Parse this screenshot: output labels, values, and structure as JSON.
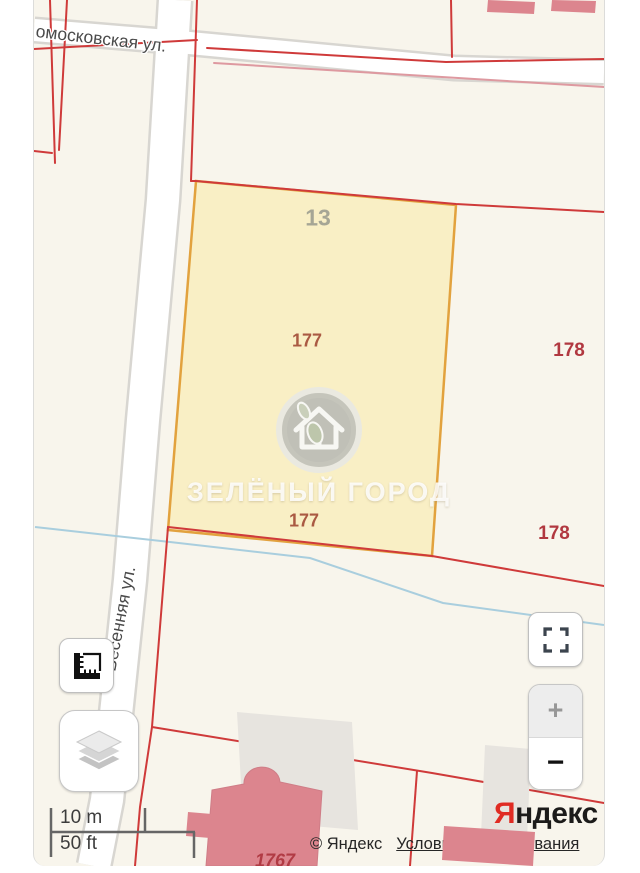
{
  "streets": {
    "top": "омосковская ул.",
    "side": "Весенняя ул."
  },
  "parcels": {
    "block_number": "13",
    "plot_number": "177",
    "adjacent_plot_number": "178",
    "building_number": "1767"
  },
  "watermark": {
    "name": "ЗЕЛЁНЫЙ ГОРОД"
  },
  "scale_bar": {
    "metric": "10 m",
    "imperial": "50 ft"
  },
  "zoom_controls": {
    "zoom_in": "+",
    "zoom_out": "−"
  },
  "attribution": {
    "copyright": "© Яндекс",
    "terms_link": "Условия использования"
  },
  "logo": {
    "letter": "Я",
    "rest": "ндекс"
  },
  "icons": {
    "ruler": "ruler-icon",
    "layers": "layers-icon",
    "fullscreen": "fullscreen-icon",
    "watermark_badge": "house-leaf-icon"
  },
  "colors": {
    "map_background": "#f8f5ec",
    "cadastral_red": "#cf3a3a",
    "plot_fill": "#f9efc5",
    "plot_border": "#e2a23e",
    "building_pink": "#dc858e",
    "water_blue": "#a9cede",
    "logo_red": "#e02b23"
  }
}
